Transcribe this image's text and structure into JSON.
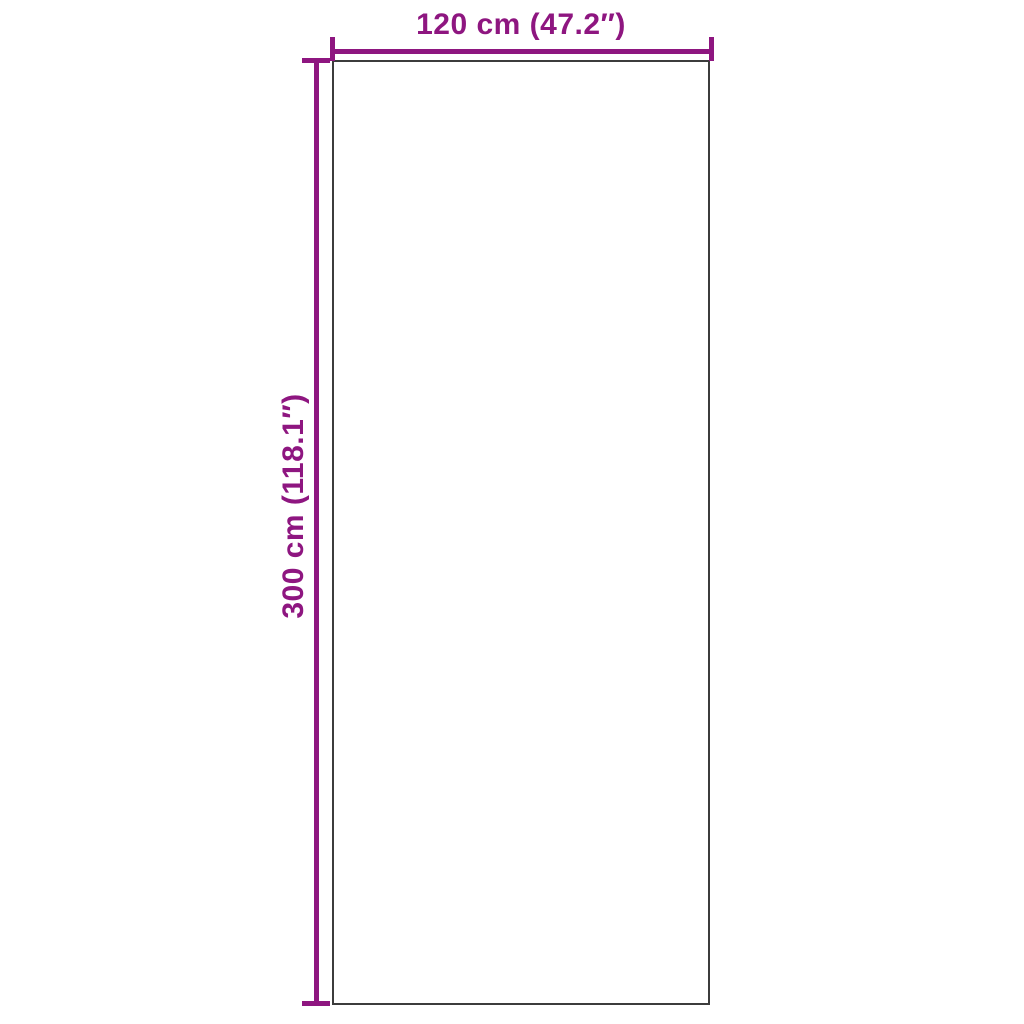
{
  "diagram": {
    "kind": "product-dimension-diagram",
    "background": "#FFFFFF",
    "colors": {
      "accent": "#8E1680",
      "outline": "#3C3C3C"
    },
    "product": {
      "shape": "rectangle"
    },
    "dimensions": {
      "width_label": "120 cm (47.2″)",
      "height_label": "300 cm (118.1″)",
      "width_cm": 120,
      "width_in": 47.2,
      "height_cm": 300,
      "height_in": 118.1
    }
  }
}
